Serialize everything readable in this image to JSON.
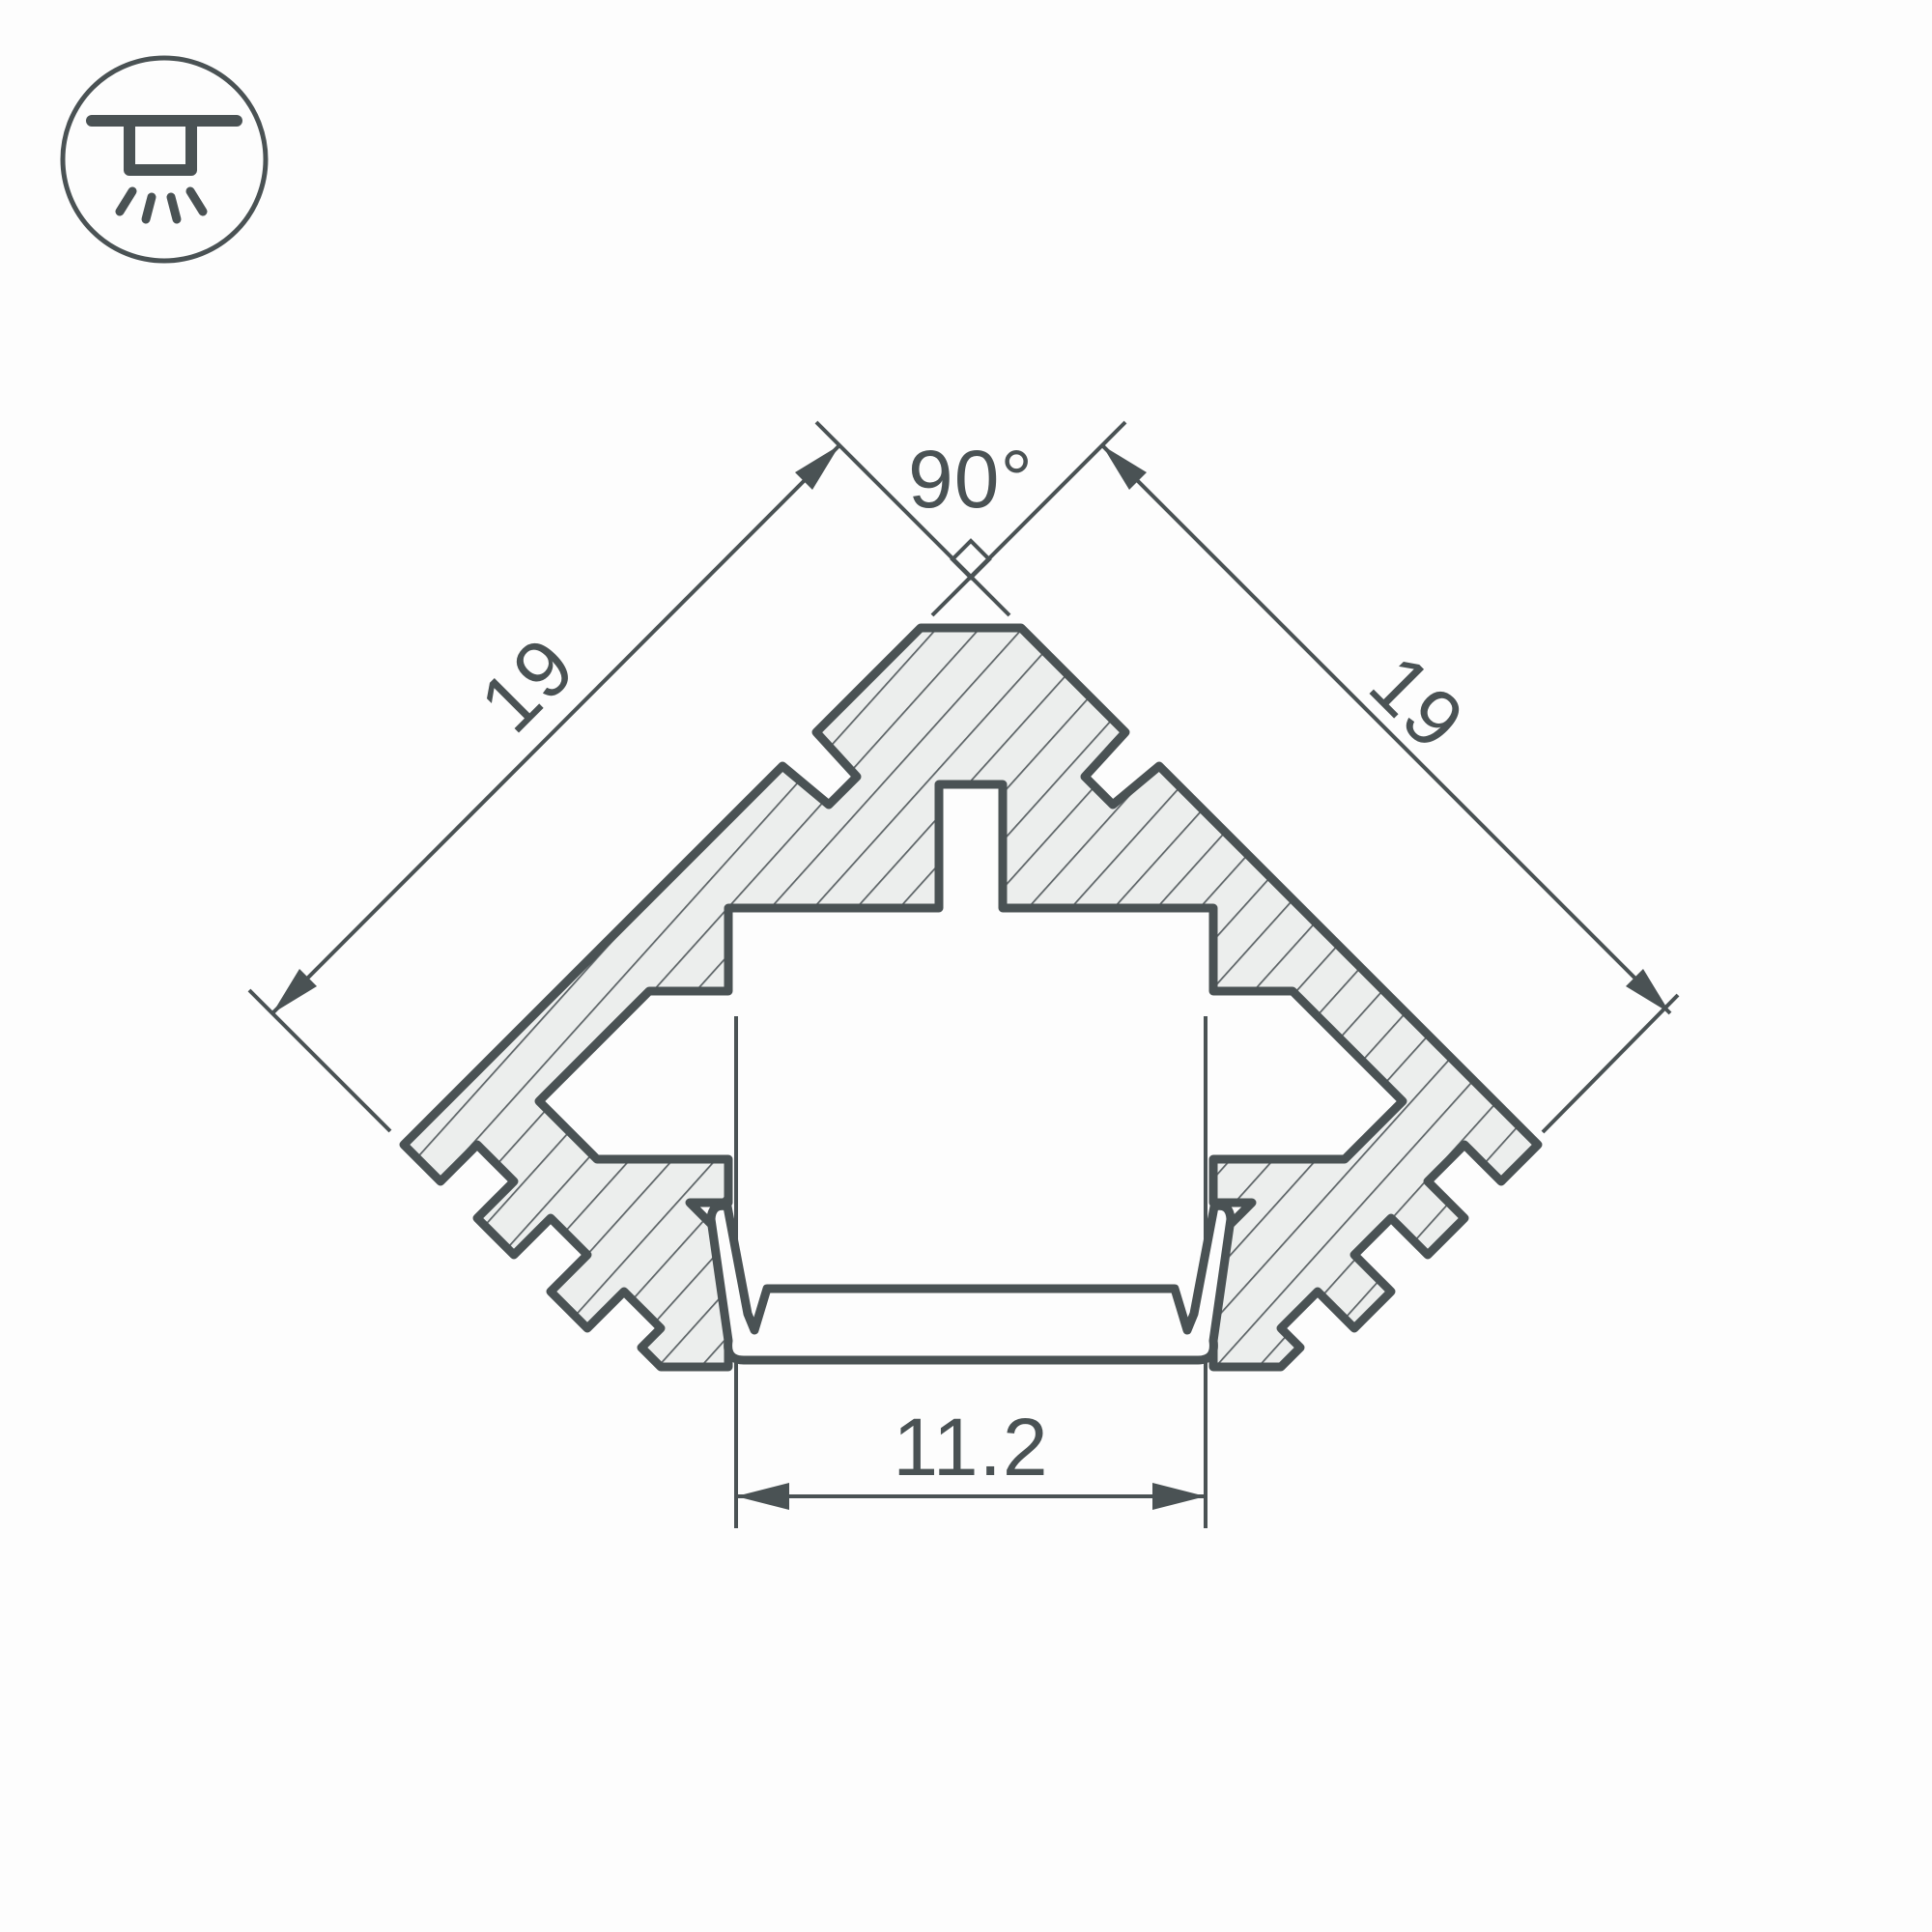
{
  "window": {
    "background": "#fdfdfd"
  },
  "badge_icon": {
    "name": "recessed-ceiling-light",
    "shape": "circle-outline"
  },
  "drawing": {
    "kind": "led-corner-profile-cross-section",
    "dimensions": {
      "apex_angle": "90°",
      "left_edge": "19",
      "right_edge": "19",
      "opening_width": "11.2"
    },
    "colors": {
      "line": "#4a5254",
      "hatch_line": "#5c6366",
      "material_fill": "#eceeed",
      "background": "#fdfdfd"
    }
  }
}
